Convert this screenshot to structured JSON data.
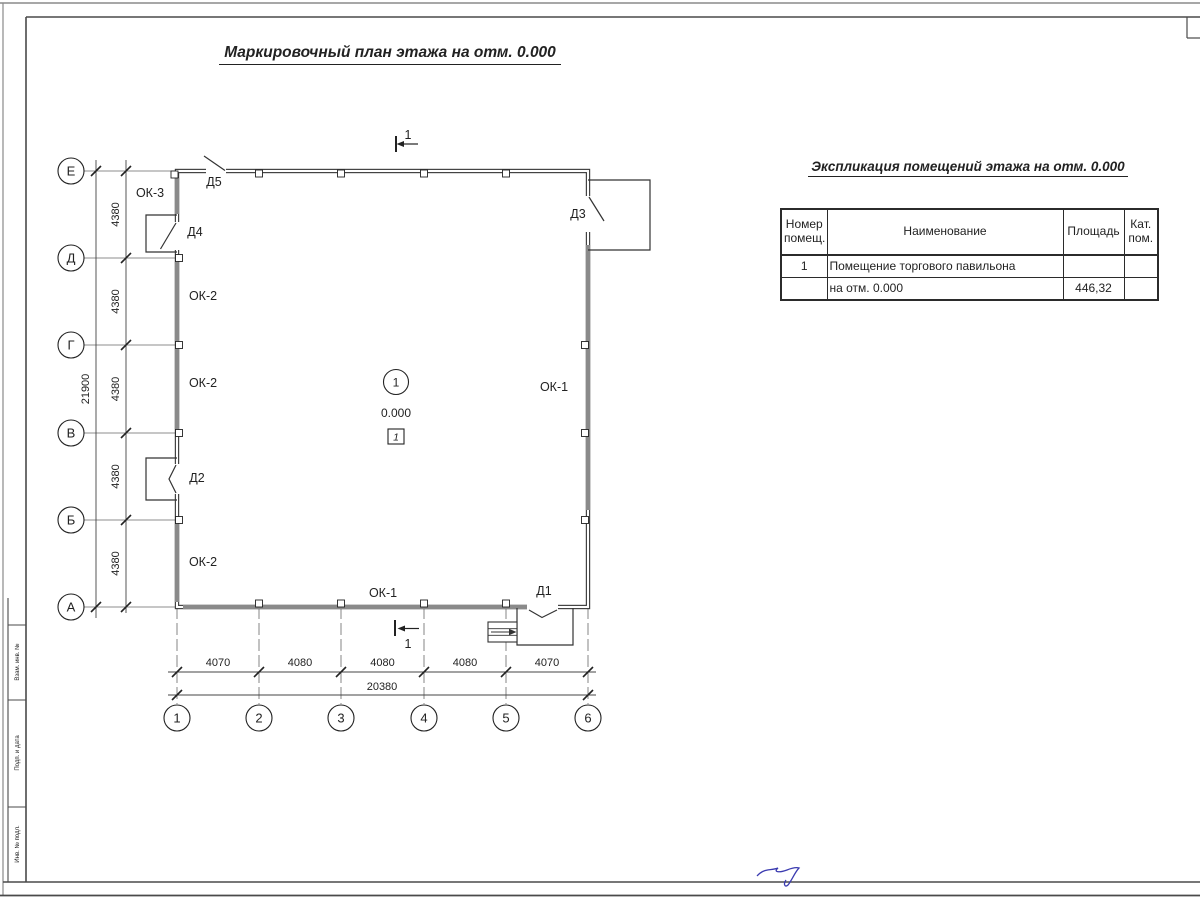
{
  "title": "Маркировочный план этажа на отм. 0.000",
  "colors": {
    "line": "#333333",
    "window_band": "#8a8a8a",
    "signature": "#3b3bb0"
  },
  "plan": {
    "axes_rows": [
      "Е",
      "Д",
      "Г",
      "В",
      "Б",
      "А"
    ],
    "axes_cols": [
      "1",
      "2",
      "3",
      "4",
      "5",
      "6"
    ],
    "dim_row_segments": [
      "4380",
      "4380",
      "4380",
      "4380",
      "4380"
    ],
    "dim_row_total": "21900",
    "dim_col_segments": [
      "4070",
      "4080",
      "4080",
      "4080",
      "4070"
    ],
    "dim_col_total": "20380",
    "labels": {
      "ok3": "ОК-3",
      "ok2_1": "ОК-2",
      "ok2_2": "ОК-2",
      "ok2_3": "ОК-2",
      "ok1_right": "ОК-1",
      "ok1_bottom": "ОК-1",
      "d1": "Д1",
      "d2": "Д2",
      "d3": "Д3",
      "d4": "Д4",
      "d5": "Д5"
    },
    "section_mark": "1",
    "room": {
      "number": "1",
      "elevation": "0.000",
      "box_number": "1"
    }
  },
  "explication": {
    "title": "Экспликация помещений этажа на отм. 0.000",
    "headers": {
      "num": "Номер помещ.",
      "name": "Наименование",
      "area": "Площадь",
      "cat": "Кат. пом."
    },
    "rows": [
      {
        "num": "1",
        "name": "Помещение торгового павильона",
        "area": "",
        "cat": ""
      },
      {
        "num": "",
        "name": "на отм. 0.000",
        "area": "446,32",
        "cat": ""
      }
    ]
  },
  "frame": {
    "stamp_boxes": [
      "Взам. инв. №",
      "Подп. и дата",
      "Инв. № подл."
    ]
  }
}
